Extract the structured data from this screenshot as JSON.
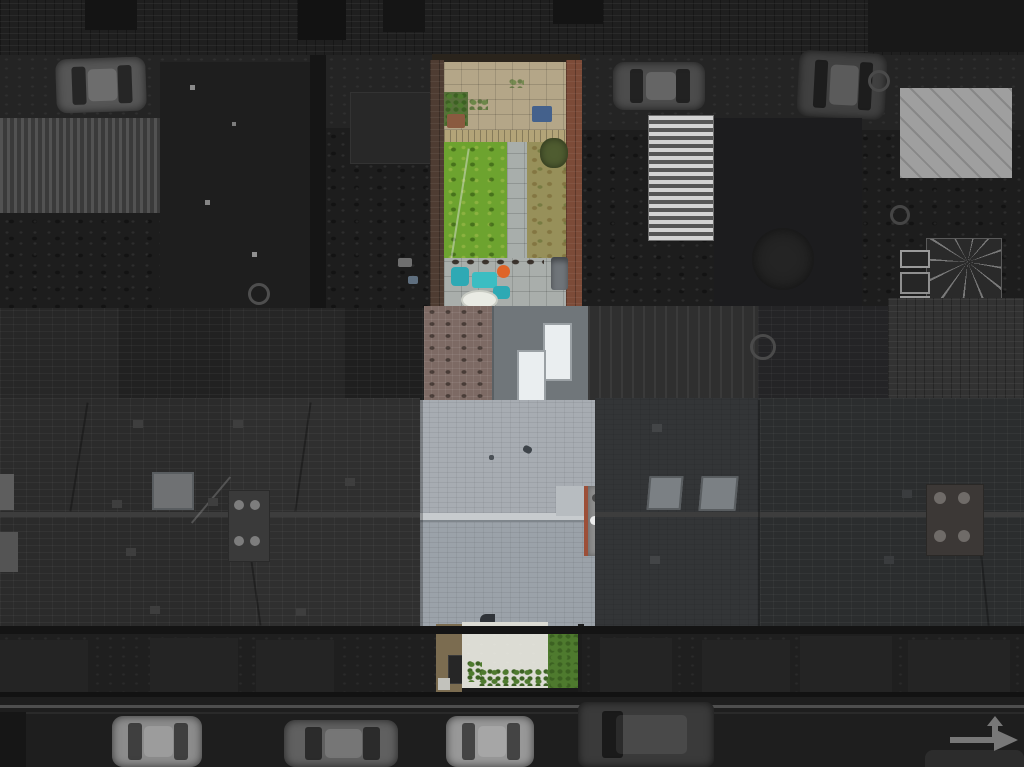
{
  "scene": {
    "type": "aerial-drone-photograph",
    "subject": "mid-terrace house with long rear garden shown in full colour",
    "surroundings": "neighbouring terraced roofs, rear alley, back yards and street rendered in dark grayscale",
    "highlight_position": "vertical strip, centre of frame",
    "street_position": "bottom edge with parked cars and painted road arrow"
  },
  "palette": {
    "backdrop": "#191919",
    "wall_dark": "#1f1f1f",
    "alley": "#242424",
    "yard": "#1d1d1d",
    "passage": "#151515",
    "corrugated_roof": "#3a3a3a",
    "shed": "#282828",
    "greenhouse": "#9d9d9d",
    "white_roof": "#9f9f9f",
    "conservatory": "#2a2a2a",
    "brick_gray": "#323232",
    "ext_roof_a": "#272727",
    "ext_roof_b": "#212121",
    "ext_roof_c": "#262626",
    "ext_roof_d": "#1f1f1f",
    "striped_roof": "#2f2f2f",
    "ext_roof_e": "#242426",
    "dark_roof_l1": "#2b2b2b",
    "dark_roof_l2": "#2f2f2f",
    "dark_roof_r1": "#333537",
    "dark_roof_r2": "#2b2d2e",
    "ridge_dark": "#3d3d3d",
    "skylight_gray": "#6f7173",
    "skylight_gray2": "#7b8084",
    "chimney_dark": "#3a3a3a",
    "chimney_pot_gray": "#7d7d7d",
    "eaves": "#141414",
    "fronts": "#1f1f1f",
    "bay_front": "#242424",
    "street": "#1e1e1e",
    "curb": "#4e4e4e",
    "car_light": "#8c8c8c",
    "car_mid": "#606060",
    "car_bright": "#989898",
    "van_dark": "#3a3a3a",
    "car_corner": "#2c2c2c",
    "car_alley": "#565656",
    "car_alley2": "#4c4c4c",
    "suv_alley": "#404040",
    "road_arrow": "#787878",
    "garden_wall_dark": "#4e3c32",
    "garden_wall_red": "#7c4b38",
    "paving_beige": "#b4a688",
    "planter_green": "#57703a",
    "pot_brown": "#8a5a40",
    "bin_blue": "#44618c",
    "fence_tan": "#b3a478",
    "lawn_green": "#6da32f",
    "lawn_dry": "#97905a",
    "garden_path": "#a8aeab",
    "bush_olive": "#4f5c30",
    "patio_slab": "#a9aeab",
    "chair_teal": "#2ea9b4",
    "table_teal": "#3bbdc2",
    "pot_orange": "#df6428",
    "pool_white": "#e9ebe4",
    "bike_gray": "#6f7479",
    "block_paving_mauve": "#7d6a64",
    "flat_roof_gray": "#70767a",
    "skylight_white": "#eaeef0",
    "roof_upper": "#a7acb2",
    "roof_lower": "#9ba2a9",
    "ridge_light": "#c7cbce",
    "roof_panel": "#b7bcc0",
    "chimney_gray": "#8d8d8d",
    "chimney_brick_red": "#9c4f38",
    "chimney_ext": "#5c5c5c",
    "front_path_brown": "#7b6c50",
    "front_paving_white": "#dcdcd4",
    "shrub_green": "#4e7a2e",
    "gate_light": "#c2c2bc",
    "bin_dark": "#262626"
  }
}
